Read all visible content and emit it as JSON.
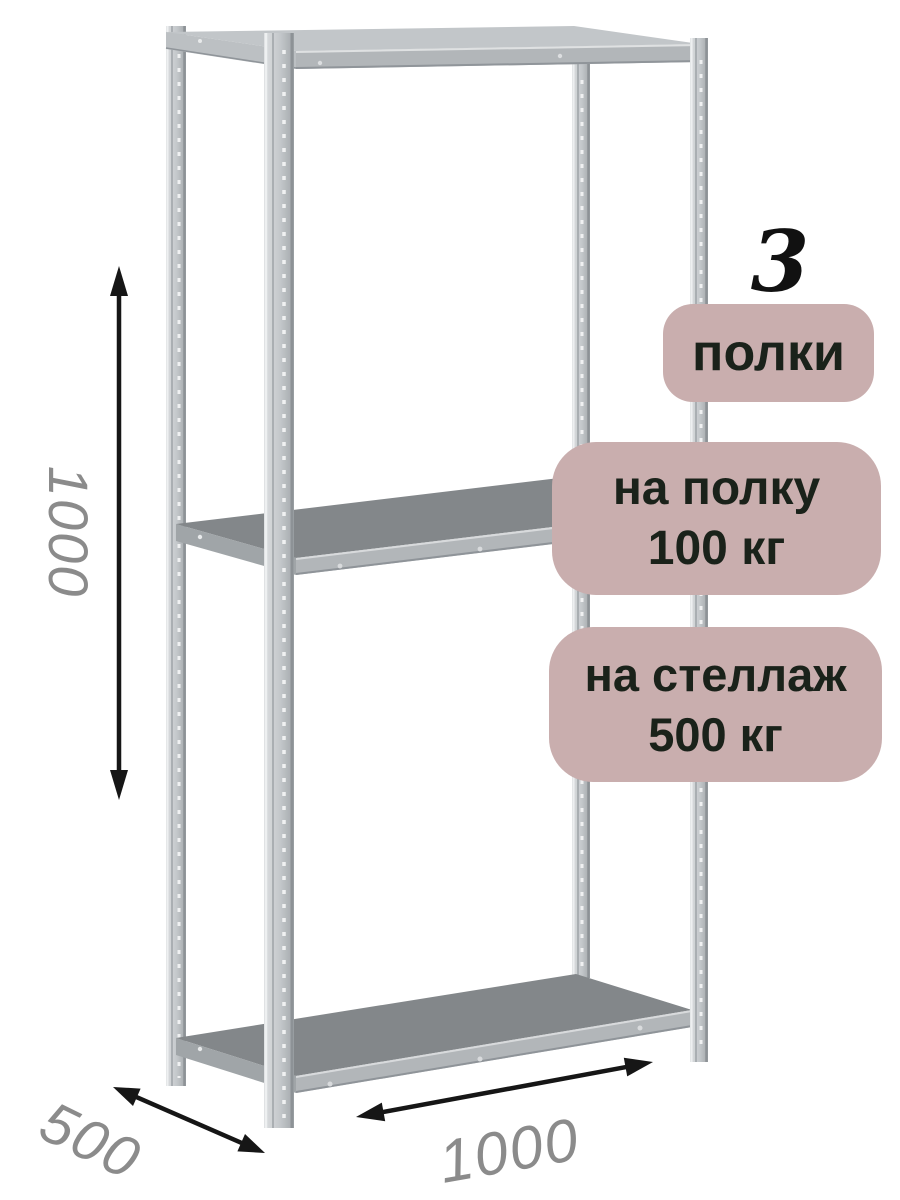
{
  "badges": {
    "background_color": "#c9aeae",
    "text_color": "#1a221a",
    "shelf_count": {
      "number": "3",
      "label": "полки"
    },
    "per_shelf_load": {
      "line1": "на полку",
      "line2": "100 кг"
    },
    "per_rack_load": {
      "line1": "на стеллаж",
      "line2": "500 кг"
    }
  },
  "dimensions": {
    "height_mm": "1000",
    "depth_mm": "500",
    "width_mm": "1000",
    "label_color": "#8b8b8b",
    "arrow_color": "#161616"
  },
  "rack": {
    "shelf_top_color": "#83878a",
    "shelf_edge_color": "#b2b6b9",
    "shelf_side_color": "#a0a5a8",
    "post_edge_color": "#8d9296"
  }
}
